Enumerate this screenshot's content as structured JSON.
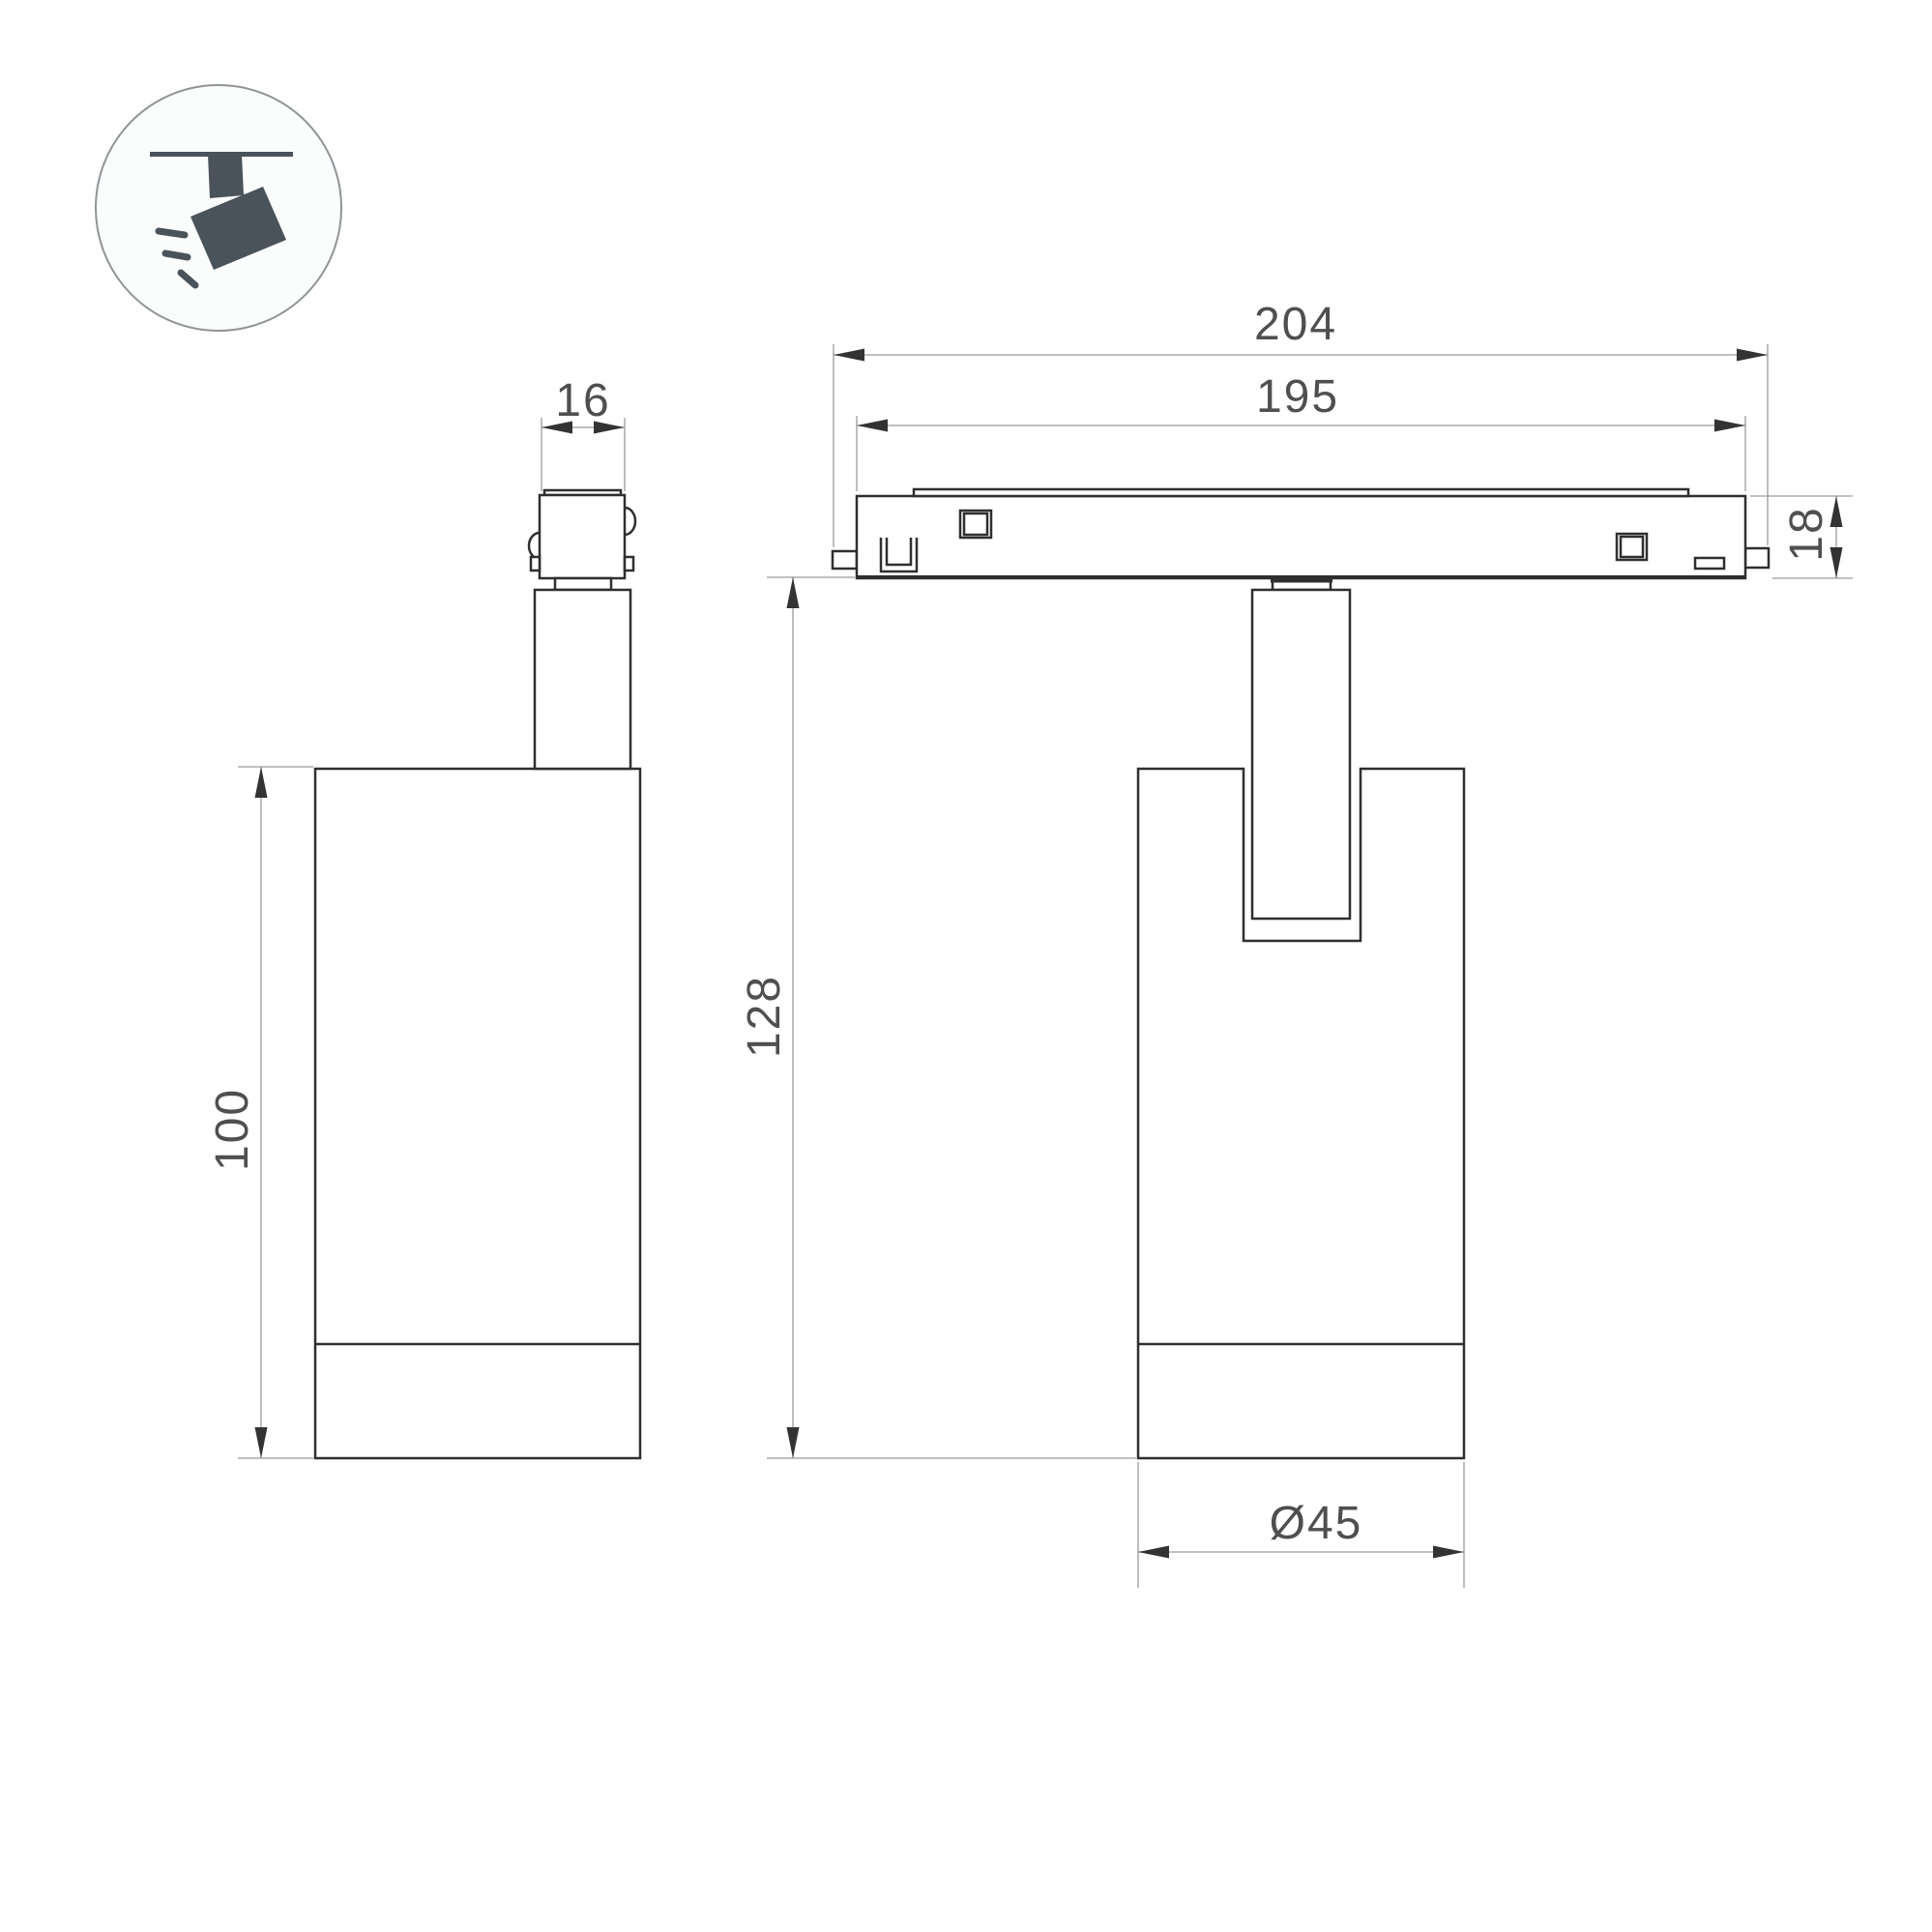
{
  "drawing": {
    "type": "technical-dimension-drawing",
    "subject": "magnetic track spotlight, two orthographic views with ceiling-track mount icon",
    "icon": {
      "name": "track-spotlight-icon",
      "description": "spotlight hanging from ceiling track, tilted, with light rays"
    },
    "dim_labels": {
      "adapter_width": "16",
      "body_height": "100",
      "track_outer_length": "204",
      "track_inner_length": "195",
      "track_height": "18",
      "overall_height": "128",
      "body_diameter": "Ø45"
    },
    "colors": {
      "background": "#ffffff",
      "outline": "#2f2f2f",
      "thin_line": "#9b9b9b",
      "dim_text": "#4f4f4f",
      "arrow": "#333333",
      "icon_fill": "#4a525b",
      "icon_circle_stroke": "#8f9496",
      "icon_circle_fill": "#fbfcfc"
    }
  }
}
